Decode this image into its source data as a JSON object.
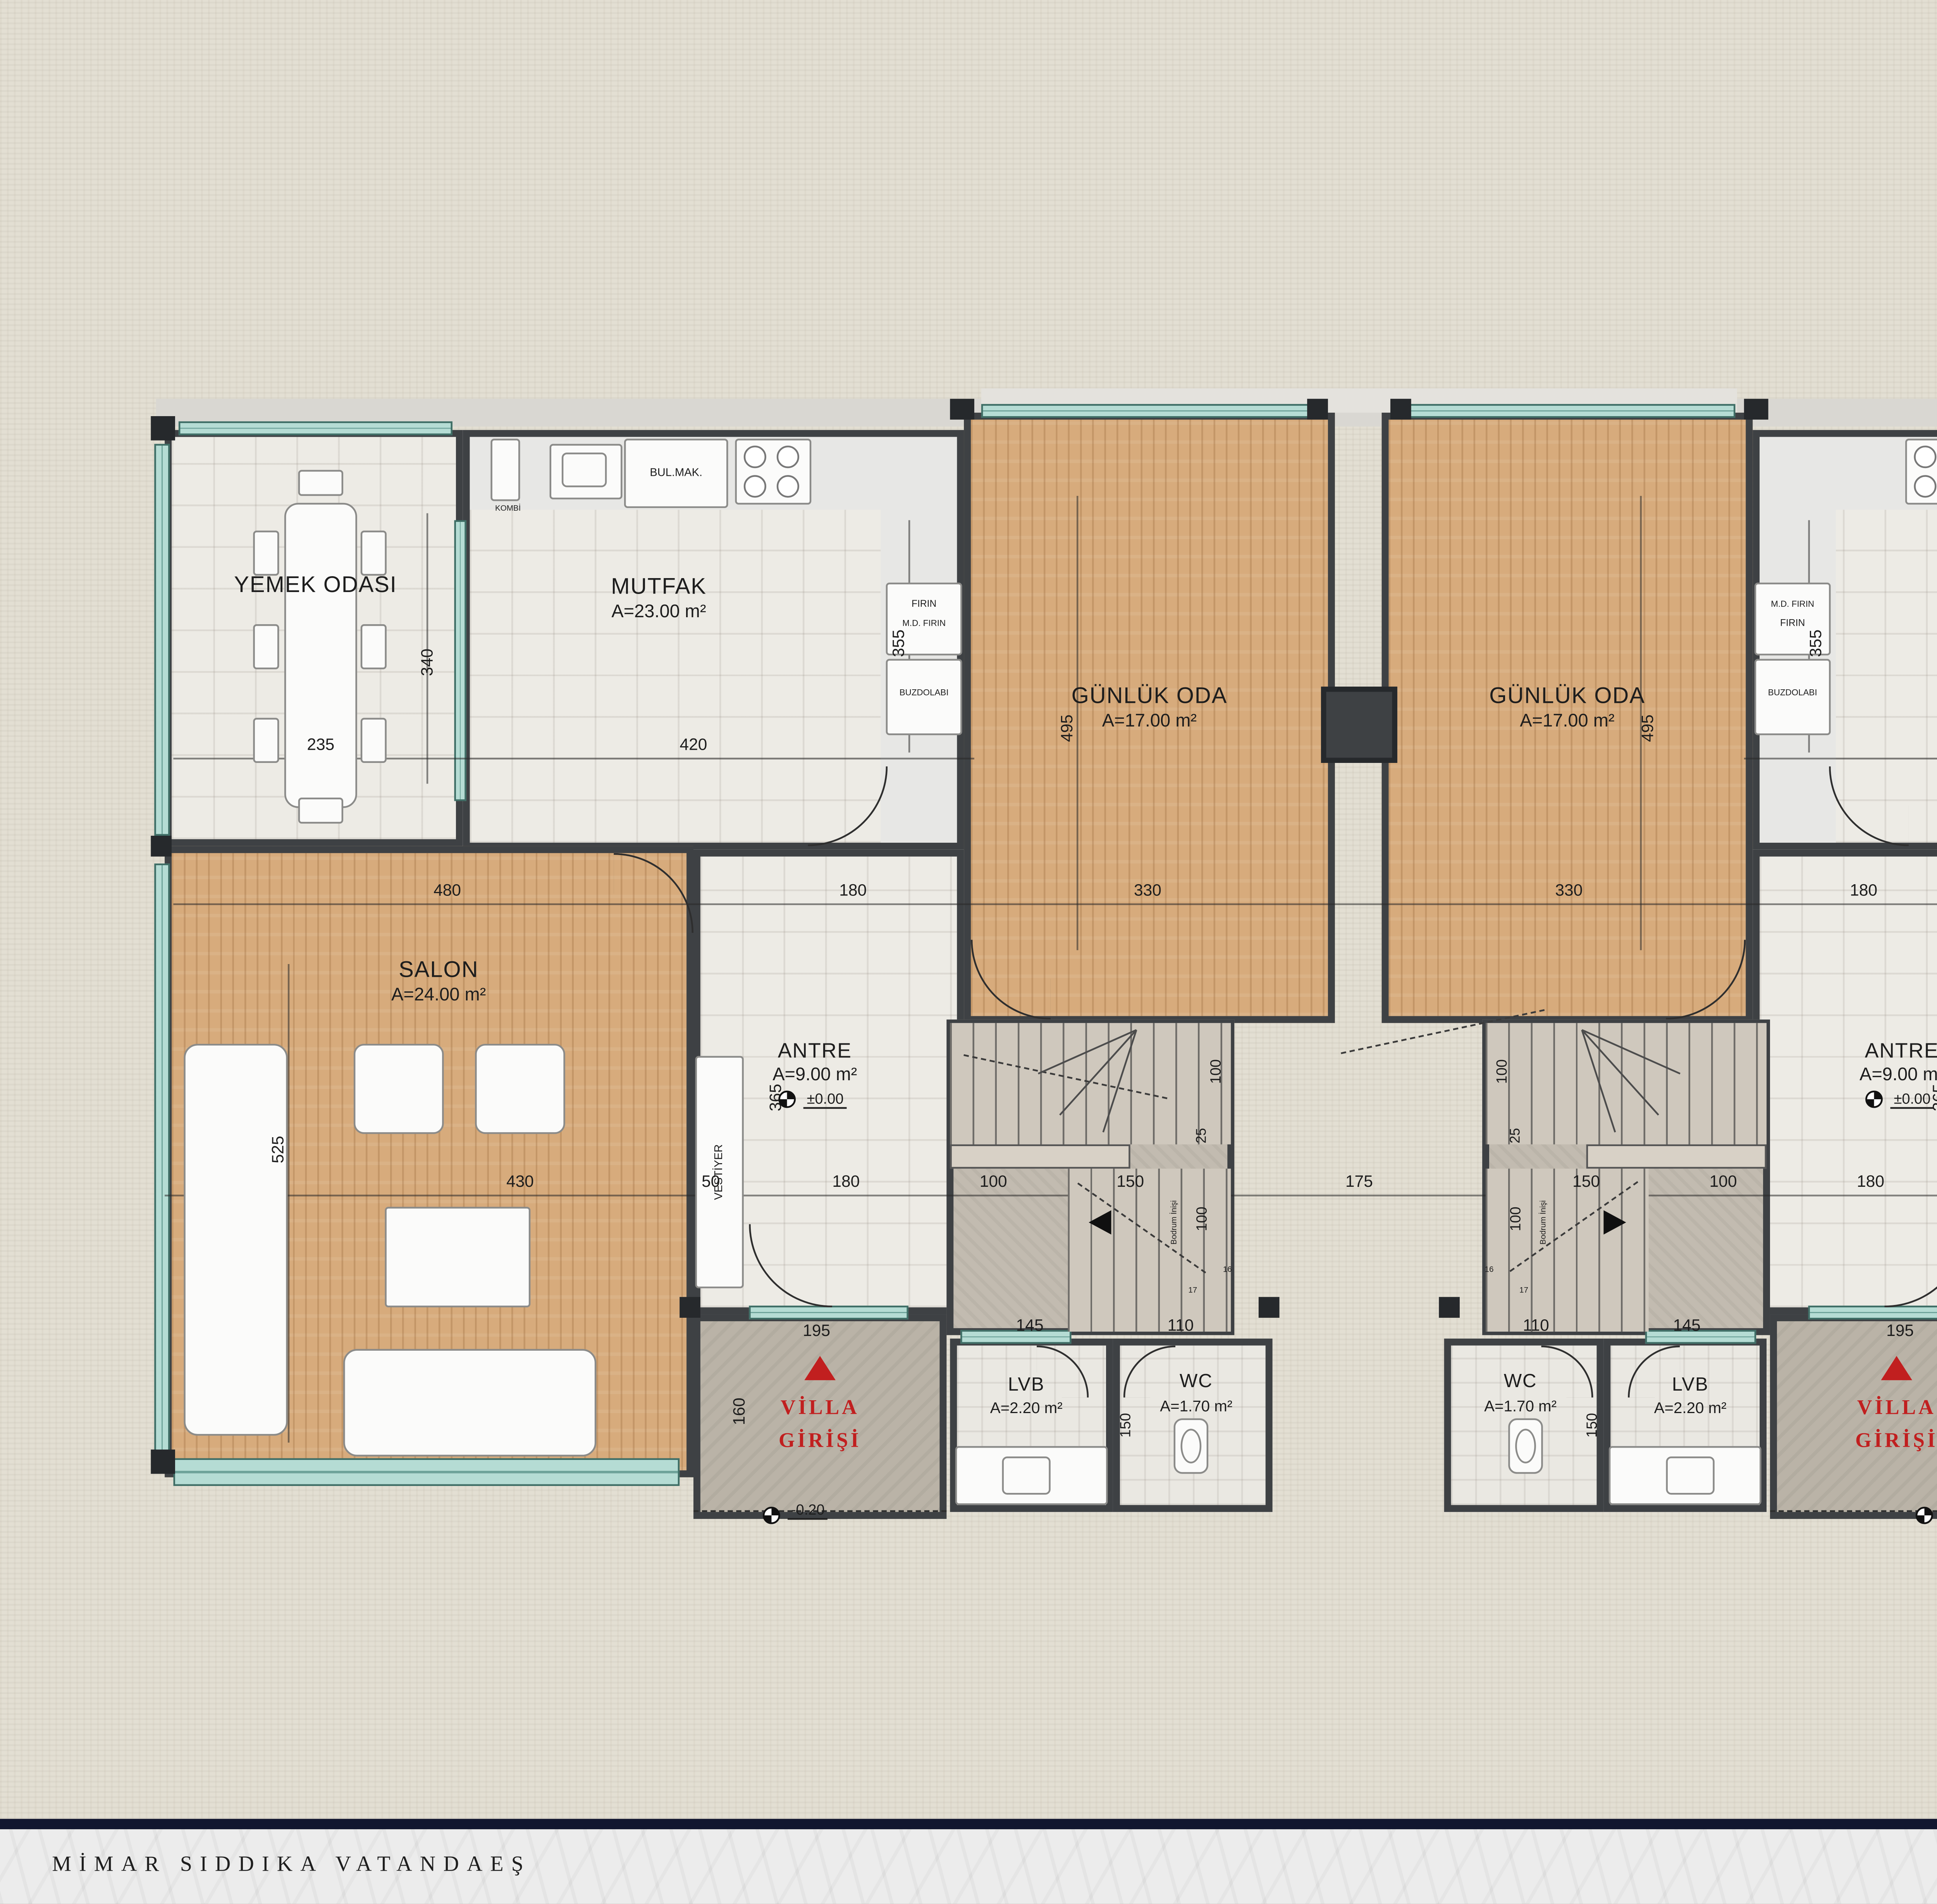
{
  "logo": {
    "line1": "GÜNIŞIĞI",
    "line2": "VİLLALARI",
    "checkmark": "✓"
  },
  "rooms": {
    "yemek": {
      "name": "YEMEK ODASI"
    },
    "mutfak": {
      "name": "MUTFAK",
      "area": "A=23.00 m²"
    },
    "gunluk": {
      "name": "GÜNLÜK ODA",
      "area": "A=17.00 m²"
    },
    "salon": {
      "name": "SALON",
      "area": "A=24.00 m²"
    },
    "antre": {
      "name": "ANTRE",
      "area": "A=9.00 m²"
    },
    "lvb": {
      "name": "LVB",
      "area": "A=2.20 m²"
    },
    "wc": {
      "name": "WC",
      "area": "A=1.70 m²"
    },
    "giris_line1": "VİLLA",
    "giris_line2": "GİRİŞİ",
    "vestiyer": "VESTİYER",
    "bodrum_inisi": "Bodrum İnişi"
  },
  "appliances": {
    "bulmak": "BUL.MAK.",
    "kombi": "KOMBİ",
    "firin": "FIRIN",
    "md_firin": "M.D. FIRIN",
    "buzdolabi": "BUZDOLABI"
  },
  "levels": {
    "ground": "±0.00",
    "entrance": "-0.20"
  },
  "dims": {
    "d16": "16",
    "d17": "17",
    "d25": "25",
    "d50": "50",
    "d100": "100",
    "d110": "110",
    "d145": "145",
    "d150": "150",
    "d160": "160",
    "d175": "175",
    "d180": "180",
    "d195": "195",
    "d235": "235",
    "d330": "330",
    "d340": "340",
    "d355": "355",
    "d365": "365",
    "d420": "420",
    "d430": "430",
    "d480": "480",
    "d495": "495",
    "d525": "525"
  },
  "info": {
    "rows": [
      {
        "label": "BODRUM KAT BRÜT ALANI:",
        "value": "40 m²"
      },
      {
        "label": "ZEMİN KAT BRÜT ALANI:",
        "value": "92 m²"
      },
      {
        "label": "1.KAT BRÜT ALANI:",
        "value": "82 m²"
      },
      {
        "label": "TOPLAM BRÜT ALANI:",
        "value": "214 m²"
      }
    ],
    "plan_title": "ZEMİN KAT PLANI"
  },
  "footer": {
    "architect": "MİMAR SIDDIKA VATANDAEŞ",
    "company": "GİRAYHAN",
    "company_subtitle": "MİMARLIK & MÜHENDİSLİK"
  }
}
